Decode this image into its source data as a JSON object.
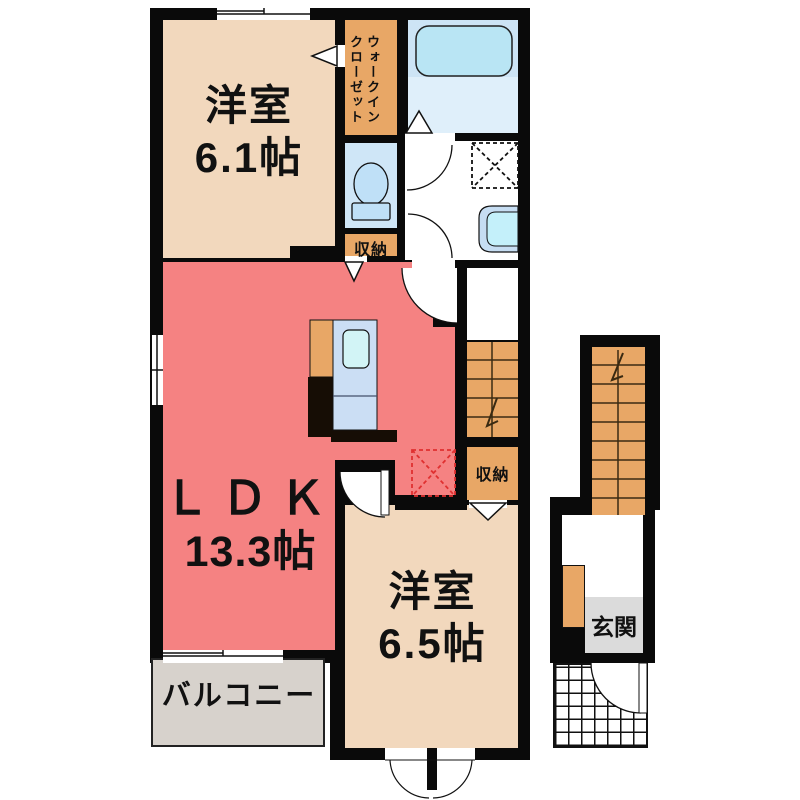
{
  "title": "間取り図",
  "rooms": {
    "west1": {
      "name": "洋室",
      "size": "6.1帖"
    },
    "west2": {
      "name": "洋室",
      "size": "6.5帖"
    },
    "ldk": {
      "name": "ＬＤＫ",
      "size": "13.3帖"
    },
    "wic": {
      "line1": "ウォークイン",
      "line2": "クローゼット"
    },
    "storage1": {
      "name": "収納"
    },
    "storage2": {
      "name": "収納"
    },
    "balcony": {
      "name": "バルコニー"
    },
    "genkan": {
      "name": "玄関"
    }
  },
  "colors": {
    "wall": "#0a0a0a",
    "room_beige": "#F2D8BD",
    "ldk_salmon": "#F58282",
    "closet_orange": "#E8A766",
    "bath_upper": "#CDE4F5",
    "bath_lower": "#DFEFFA",
    "tub_blue": "#B9E5F4",
    "toilet_blue": "#CFE6F7",
    "fixture_blue": "#BFE0F7",
    "counter_blue": "#CBDEF4",
    "sink_cyan": "#D2F4F6",
    "basin_outer": "#C6DDF2",
    "basin_inner": "#C4F0FA",
    "balcony_gray": "#D7D2CC",
    "genkan_gray": "#DBDBDB",
    "fridge_marker_red": "#E03030"
  }
}
